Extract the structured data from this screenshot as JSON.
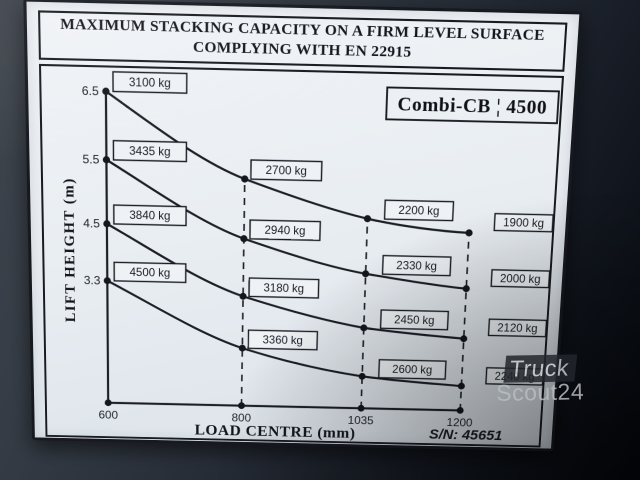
{
  "plate": {
    "title_line1": "MAXIMUM STACKING CAPACITY ON A FIRM LEVEL SURFACE",
    "title_line2": "COMPLYING WITH EN 22915",
    "model_label": "Combi-CB ¦ 4500",
    "serial_label": "S/N: 45651"
  },
  "watermark": {
    "line1": "Truck",
    "line2": "Scout24"
  },
  "chart_data": {
    "type": "line",
    "title": "Maximum stacking capacity on a firm level surface complying with EN 22915 — Combi-CB 4500",
    "xlabel": "LOAD CENTRE (mm)",
    "ylabel": "LIFT HEIGHT (m)",
    "x": [
      600,
      800,
      1035,
      1200
    ],
    "x_tick_labels": [
      "600",
      "800",
      "1035",
      "1200"
    ],
    "y_tick_labels": [
      "6.5",
      "5.5",
      "4.5",
      "3.3"
    ],
    "y_axis_values_m": [
      6.5,
      5.5,
      4.5,
      3.3
    ],
    "grid": "dashed vertical guides at 800, 1035 and 1200 mm",
    "legend": "none",
    "series": [
      {
        "name": "Lift height 6.5 m",
        "lift_height_m": 6.5,
        "values_kg": [
          3100,
          2700,
          2200,
          1900
        ],
        "labels": [
          "3100 kg",
          "2700 kg",
          "2200 kg",
          "1900 kg"
        ]
      },
      {
        "name": "Lift height 5.5 m",
        "lift_height_m": 5.5,
        "values_kg": [
          3435,
          2940,
          2330,
          2000
        ],
        "labels": [
          "3435 kg",
          "2940 kg",
          "2330 kg",
          "2000 kg"
        ]
      },
      {
        "name": "Lift height 4.5 m",
        "lift_height_m": 4.5,
        "values_kg": [
          3840,
          3180,
          2450,
          2120
        ],
        "labels": [
          "3840 kg",
          "3180 kg",
          "2450 kg",
          "2120 kg"
        ]
      },
      {
        "name": "Lift height 3.3 m",
        "lift_height_m": 3.3,
        "values_kg": [
          4500,
          3360,
          2600,
          2240
        ],
        "labels": [
          "4500 kg",
          "3360 kg",
          "2600 kg",
          "2240 kg"
        ]
      }
    ]
  },
  "colors": {
    "plate_background": "#e9eef2",
    "ink": "#1c1e26",
    "photo_background_top": "#40464e",
    "photo_background_bottom": "#06090f",
    "watermark_text": "#b7bcc2",
    "watermark_badge": "#23262c"
  }
}
